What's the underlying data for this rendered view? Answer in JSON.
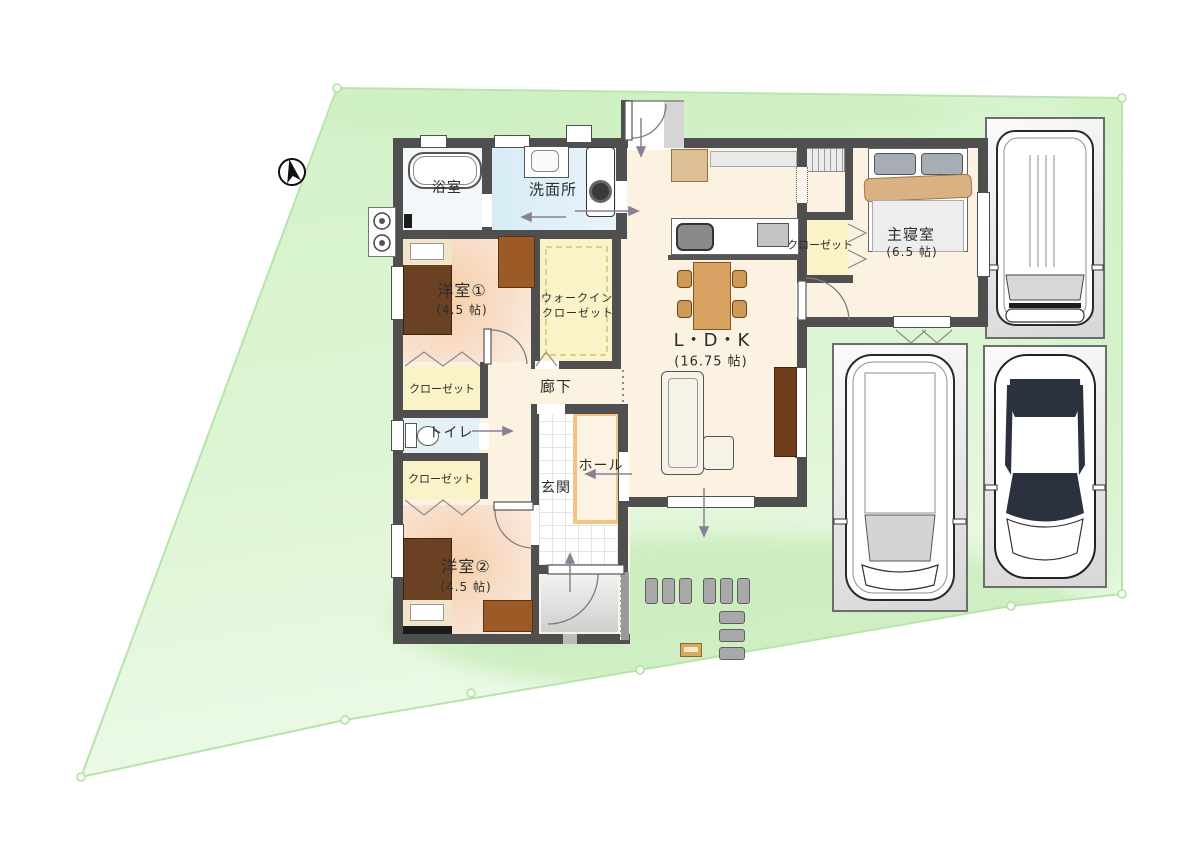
{
  "plan": {
    "type": "site-and-floor-plan",
    "compass": "north-arrow"
  },
  "rooms": {
    "bath": {
      "label": "浴室"
    },
    "washroom": {
      "label": "洗面所"
    },
    "west_room_1": {
      "label": "洋室①",
      "size": "(4.5 帖)"
    },
    "walk_in_closet": {
      "line1": "ウォークイン",
      "line2": "クローゼット"
    },
    "closet_1": {
      "label": "クローゼット"
    },
    "corridor": {
      "label": "廊下"
    },
    "toilet": {
      "label": "トイレ"
    },
    "closet_2": {
      "label": "クローゼット"
    },
    "west_room_2": {
      "label": "洋室②",
      "size": "(4.5 帖)"
    },
    "entrance": {
      "label": "玄関"
    },
    "hall": {
      "label": "ホール"
    },
    "ldk": {
      "label": "L・D・K",
      "size": "(16.75 帖)"
    },
    "master_closet": {
      "label": "クローゼット"
    },
    "master_bedroom": {
      "label": "主寝室",
      "size": "(6.5 帖)"
    }
  },
  "colors": {
    "wall": "#4f4f4f",
    "site_green_top": "#d3f2c9",
    "site_green_bottom": "#edfae8",
    "site_boundary": "#b7e3ac",
    "closet_yellow": "#faf3c8",
    "wet_room_blue": "#dceef6",
    "bedroom_peach": "#f6d5b2",
    "floor_cream": "#fbf2e2",
    "wood_brown": "#6b4123",
    "table_tan": "#d8a162",
    "hall_trim_orange": "#f2c382"
  }
}
